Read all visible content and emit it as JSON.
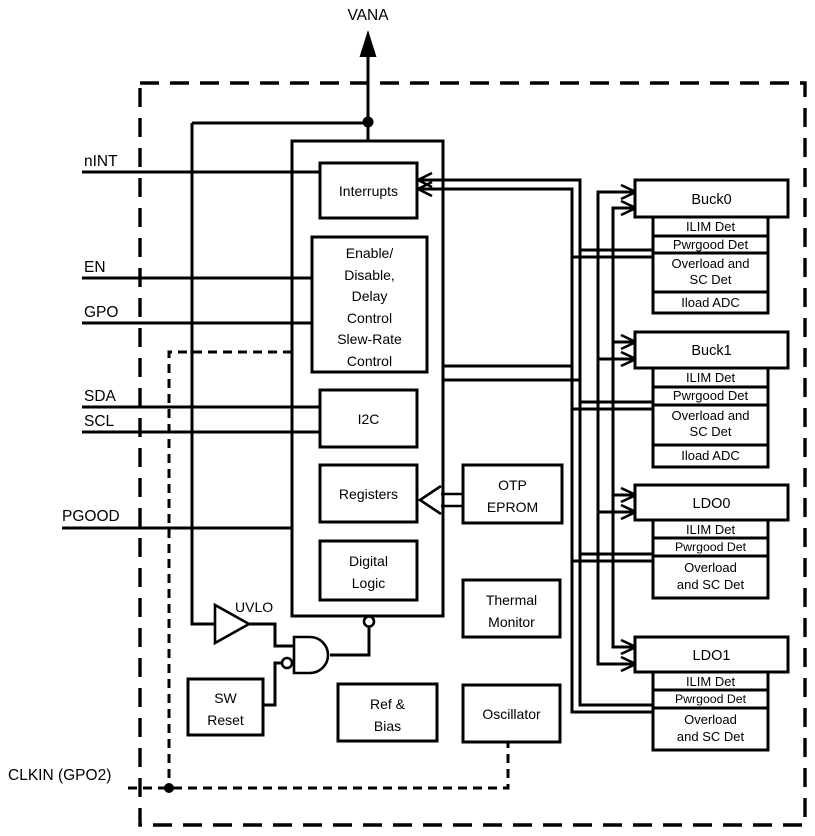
{
  "supply": {
    "label": "VANA"
  },
  "pins": {
    "nint": {
      "label": "nINT"
    },
    "en": {
      "label": "EN"
    },
    "gpo": {
      "label": "GPO"
    },
    "sda": {
      "label": "SDA"
    },
    "scl": {
      "label": "SCL"
    },
    "pgood": {
      "label": "PGOOD"
    },
    "clkin": {
      "label": "CLKIN (GPO2)"
    }
  },
  "core": {
    "interrupts": {
      "label": "Interrupts"
    },
    "enable": {
      "lines": [
        "Enable/",
        "Disable,",
        "Delay",
        "Control",
        "Slew-Rate",
        "Control"
      ]
    },
    "i2c": {
      "label": "I2C"
    },
    "registers": {
      "label": "Registers"
    },
    "digital": {
      "lines": [
        "Digital",
        "Logic"
      ]
    },
    "otp": {
      "lines": [
        "OTP",
        "EPROM"
      ]
    },
    "thermal": {
      "lines": [
        "Thermal",
        "Monitor"
      ]
    },
    "ref_bias": {
      "lines": [
        "Ref &",
        "Bias"
      ]
    },
    "oscillator": {
      "label": "Oscillator"
    },
    "sw_reset": {
      "lines": [
        "SW",
        "Reset"
      ]
    },
    "uvlo": {
      "label": "UVLO"
    }
  },
  "outputs": {
    "buck0": {
      "title": "Buck0",
      "ilim": "ILIM Det",
      "pwrgood": "Pwrgood Det",
      "overload1": "Overload and",
      "overload2": "SC Det",
      "iload": "Iload ADC"
    },
    "buck1": {
      "title": "Buck1",
      "ilim": "ILIM Det",
      "pwrgood": "Pwrgood Det",
      "overload1": "Overload and",
      "overload2": "SC Det",
      "iload": "Iload ADC"
    },
    "ldo0": {
      "title": "LDO0",
      "ilim": "ILIM Det",
      "pwrgood": "Pwrgood Det",
      "overload1": "Overload",
      "overload2": "and SC Det"
    },
    "ldo1": {
      "title": "LDO1",
      "ilim": "ILIM Det",
      "pwrgood": "Pwrgood Det",
      "overload1": "Overload",
      "overload2": "and SC Det"
    }
  },
  "colors": {
    "ink": "#000000",
    "background": "#ffffff"
  }
}
